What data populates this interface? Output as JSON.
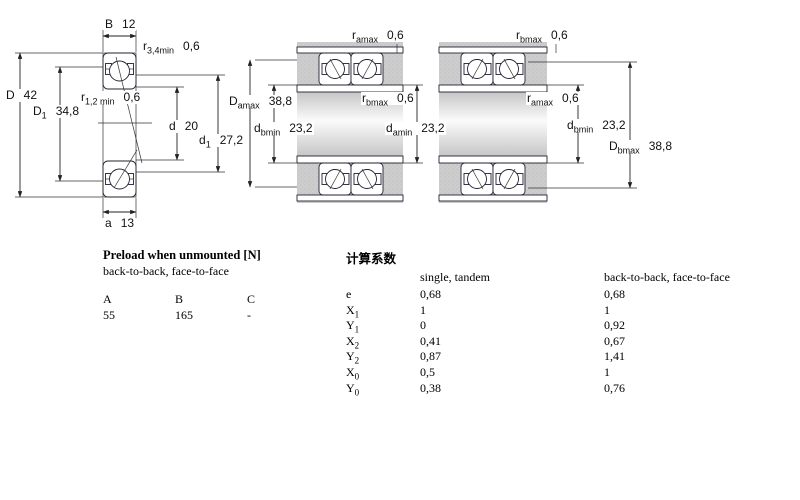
{
  "diagram": {
    "left": {
      "labels": {
        "B": {
          "sym": "B",
          "sub": "",
          "val": "12"
        },
        "r34": {
          "sym": "r",
          "sub": "3,4min",
          "val": "0,6"
        },
        "D": {
          "sym": "D",
          "sub": "",
          "val": "42"
        },
        "D1": {
          "sym": "D",
          "sub": "1",
          "val": "34,8"
        },
        "r12": {
          "sym": "r",
          "sub": "1,2 min",
          "val": "0,6"
        },
        "d": {
          "sym": "d",
          "sub": "",
          "val": "20"
        },
        "d1": {
          "sym": "d",
          "sub": "1",
          "val": "27,2"
        },
        "a": {
          "sym": "a",
          "sub": "",
          "val": "13"
        }
      }
    },
    "middle": {
      "labels": {
        "r_amax": {
          "sym": "r",
          "sub": "amax",
          "val": "0,6"
        },
        "D_amax": {
          "sym": "D",
          "sub": "amax",
          "val": "38,8"
        },
        "d_bmin": {
          "sym": "d",
          "sub": "bmin",
          "val": "23,2"
        },
        "r_bmax": {
          "sym": "r",
          "sub": "bmax",
          "val": "0,6"
        },
        "d_amin": {
          "sym": "d",
          "sub": "amin",
          "val": "23,2"
        }
      }
    },
    "right": {
      "labels": {
        "r_bmax": {
          "sym": "r",
          "sub": "bmax",
          "val": "0,6"
        },
        "r_amax": {
          "sym": "r",
          "sub": "amax",
          "val": "0,6"
        },
        "d_bmin": {
          "sym": "d",
          "sub": "bmin",
          "val": "23,2"
        },
        "D_bmax": {
          "sym": "D",
          "sub": "bmax",
          "val": "38,8"
        }
      }
    }
  },
  "preload": {
    "title": "Preload when unmounted [N]",
    "subtitle": "back-to-back, face-to-face",
    "headers": [
      "A",
      "B",
      "C"
    ],
    "values": [
      "55",
      "165",
      "-"
    ]
  },
  "factors": {
    "title": "计算系数",
    "col1": "single, tandem",
    "col2": "back-to-back, face-to-face",
    "rows": [
      {
        "sym": "e",
        "sub": "",
        "single": "0,68",
        "pair": "0,68"
      },
      {
        "sym": "X",
        "sub": "1",
        "single": "1",
        "pair": "1"
      },
      {
        "sym": "Y",
        "sub": "1",
        "single": "0",
        "pair": "0,92"
      },
      {
        "sym": "X",
        "sub": "2",
        "single": "0,41",
        "pair": "0,67"
      },
      {
        "sym": "Y",
        "sub": "2",
        "single": "0,87",
        "pair": "1,41"
      },
      {
        "sym": "X",
        "sub": "0",
        "single": "0,5",
        "pair": "1"
      },
      {
        "sym": "Y",
        "sub": "0",
        "single": "0,38",
        "pair": "0,76"
      }
    ]
  },
  "colors": {
    "ring_fill": "#b9cbe2",
    "ring_dot": "#7e9cc0",
    "housing_gray": "#cbcbcb",
    "line": "#222222"
  }
}
